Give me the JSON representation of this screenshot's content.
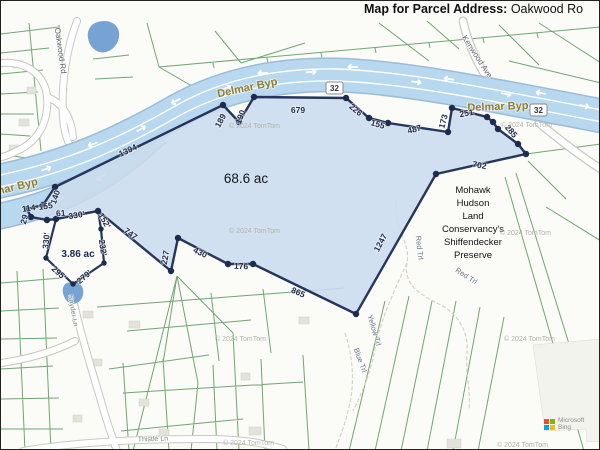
{
  "title": {
    "bold": "Map for Parcel Address:",
    "rest": " Oakwood Ro"
  },
  "parcel_summary": {
    "main_area": "68.6 ac",
    "small_area": "3.86 ac",
    "preserve_name": "Mohawk Hudson Land Conservancy's Shiffendecker Preserve"
  },
  "bing": {
    "brand": "Microsoft",
    "product": "Bing",
    "logo_colors": [
      "#f25022",
      "#7fba00",
      "#00a4ef",
      "#ffb900"
    ]
  },
  "colors": {
    "parcel_fill": "#cbdcee",
    "parcel_stroke": "#26355a",
    "highway": "#b7d8ee",
    "lot_lines": "#6aa06a",
    "road_label": "#8f7f2e",
    "pond": "#76a3d4"
  },
  "labels": [
    {
      "t": "Delmar Byp",
      "x": 247,
      "y": 90,
      "r": -12,
      "c": "road-olive"
    },
    {
      "t": "Delmar Byp",
      "x": 497,
      "y": 109,
      "r": -2,
      "c": "road-olive"
    },
    {
      "t": "mar Byp",
      "x": 16,
      "y": 189,
      "r": -14,
      "c": "road-olive"
    },
    {
      "t": "Kenwood Ave",
      "x": 474,
      "y": 57,
      "r": 57,
      "c": "road-gray"
    },
    {
      "t": "Oakwood Rd",
      "x": 57,
      "y": 50,
      "r": 82,
      "c": "road-gray"
    },
    {
      "t": "Thistle Ln",
      "x": 152,
      "y": 440,
      "r": -2,
      "c": "street"
    },
    {
      "t": "Snyder Ln",
      "x": 70,
      "y": 310,
      "r": 80,
      "c": "street"
    },
    {
      "t": "68.6 ac",
      "x": 245,
      "y": 182,
      "r": 0,
      "c": "area-main"
    },
    {
      "t": "3.86 ac",
      "x": 77,
      "y": 256,
      "r": 0,
      "c": "area-small"
    },
    {
      "t": "Mohawk",
      "x": 472,
      "y": 192,
      "r": 0,
      "c": "preserve"
    },
    {
      "t": "Hudson",
      "x": 472,
      "y": 205,
      "r": 0,
      "c": "preserve"
    },
    {
      "t": "Land",
      "x": 472,
      "y": 218,
      "r": 0,
      "c": "preserve"
    },
    {
      "t": "Conservancy's",
      "x": 472,
      "y": 231,
      "r": 0,
      "c": "preserve"
    },
    {
      "t": "Shiffendecker",
      "x": 472,
      "y": 244,
      "r": 0,
      "c": "preserve"
    },
    {
      "t": "Preserve",
      "x": 472,
      "y": 257,
      "r": 0,
      "c": "preserve"
    },
    {
      "t": "Red Trl",
      "x": 416,
      "y": 247,
      "r": 84,
      "c": "trail"
    },
    {
      "t": "Red Trl",
      "x": 464,
      "y": 277,
      "r": 33,
      "c": "trail"
    },
    {
      "t": "Yellow Trl",
      "x": 371,
      "y": 330,
      "r": 73,
      "c": "trail"
    },
    {
      "t": "Blue Trl",
      "x": 357,
      "y": 360,
      "r": 70,
      "c": "trail"
    },
    {
      "t": "32",
      "x": 333.5,
      "y": 90,
      "r": 0,
      "c": "shield"
    },
    {
      "t": "32",
      "x": 537.5,
      "y": 112,
      "r": 0,
      "c": "shield"
    },
    {
      "t": "1394",
      "x": 128,
      "y": 152,
      "r": -25,
      "c": "edge"
    },
    {
      "t": "189",
      "x": 222,
      "y": 121,
      "r": -62,
      "c": "edge"
    },
    {
      "t": "190",
      "x": 242,
      "y": 117,
      "r": -68,
      "c": "edge"
    },
    {
      "t": "679",
      "x": 297,
      "y": 112,
      "r": 0,
      "c": "edge"
    },
    {
      "t": "226",
      "x": 353,
      "y": 111,
      "r": 40,
      "c": "edge"
    },
    {
      "t": "155",
      "x": 376,
      "y": 126,
      "r": 16,
      "c": "edge"
    },
    {
      "t": "487",
      "x": 414,
      "y": 131,
      "r": -14,
      "c": "edge"
    },
    {
      "t": "173",
      "x": 445,
      "y": 121,
      "r": -76,
      "c": "edge"
    },
    {
      "t": "251",
      "x": 466,
      "y": 115,
      "r": -10,
      "c": "edge"
    },
    {
      "t": "285",
      "x": 508,
      "y": 132,
      "r": 50,
      "c": "edge"
    },
    {
      "t": "702",
      "x": 478,
      "y": 167,
      "r": 10,
      "c": "edge"
    },
    {
      "t": "1247",
      "x": 382,
      "y": 243,
      "r": -62,
      "c": "edge"
    },
    {
      "t": "865",
      "x": 296,
      "y": 294,
      "r": 24,
      "c": "edge"
    },
    {
      "t": "176",
      "x": 240,
      "y": 268,
      "r": 2,
      "c": "edge"
    },
    {
      "t": "430",
      "x": 198,
      "y": 254,
      "r": 26,
      "c": "edge"
    },
    {
      "t": "227",
      "x": 167,
      "y": 257,
      "r": -80,
      "c": "edge"
    },
    {
      "t": "747",
      "x": 128,
      "y": 235,
      "r": 36,
      "c": "edge"
    },
    {
      "t": "140",
      "x": 57,
      "y": 197,
      "r": -72,
      "c": "edge"
    },
    {
      "t": "155",
      "x": 45,
      "y": 208,
      "r": -8,
      "c": "edge"
    },
    {
      "t": "114",
      "x": 28,
      "y": 210,
      "r": -8,
      "c": "edge"
    },
    {
      "t": "29",
      "x": 26,
      "y": 219,
      "r": -75,
      "c": "edge"
    },
    {
      "t": "61",
      "x": 60,
      "y": 215,
      "r": -5,
      "c": "edge"
    },
    {
      "t": "330'",
      "x": 76,
      "y": 217,
      "r": -9,
      "c": "edge"
    },
    {
      "t": "152'",
      "x": 101,
      "y": 221,
      "r": 60,
      "c": "edge"
    },
    {
      "t": "232'",
      "x": 99,
      "y": 247,
      "r": 82,
      "c": "edge"
    },
    {
      "t": "279'",
      "x": 85,
      "y": 278,
      "r": -40,
      "c": "edge"
    },
    {
      "t": "295'",
      "x": 56,
      "y": 274,
      "r": 42,
      "c": "edge"
    },
    {
      "t": "330'",
      "x": 48,
      "y": 240,
      "r": -85,
      "c": "edge"
    },
    {
      "t": "© 2024 TomTom",
      "x": 228,
      "y": 127,
      "r": 0,
      "c": "copy"
    },
    {
      "t": "© 2024 TomTom",
      "x": 228,
      "y": 232,
      "r": 0,
      "c": "copy"
    },
    {
      "t": "© 2024 TomTom",
      "x": 214,
      "y": 340,
      "r": 0,
      "c": "copy"
    },
    {
      "t": "© 2024 TomTom",
      "x": 222,
      "y": 444,
      "r": 0,
      "c": "copy"
    },
    {
      "t": "© 2024 TomTom",
      "x": 500,
      "y": 126,
      "r": 0,
      "c": "copy"
    },
    {
      "t": "© 2024 TomTom",
      "x": 499,
      "y": 234,
      "r": 0,
      "c": "copy"
    },
    {
      "t": "© 2024 TomTom",
      "x": 503,
      "y": 340,
      "r": 0,
      "c": "copy"
    },
    {
      "t": "© 2024 TomTom",
      "x": 496,
      "y": 446,
      "r": 0,
      "c": "copy"
    }
  ]
}
